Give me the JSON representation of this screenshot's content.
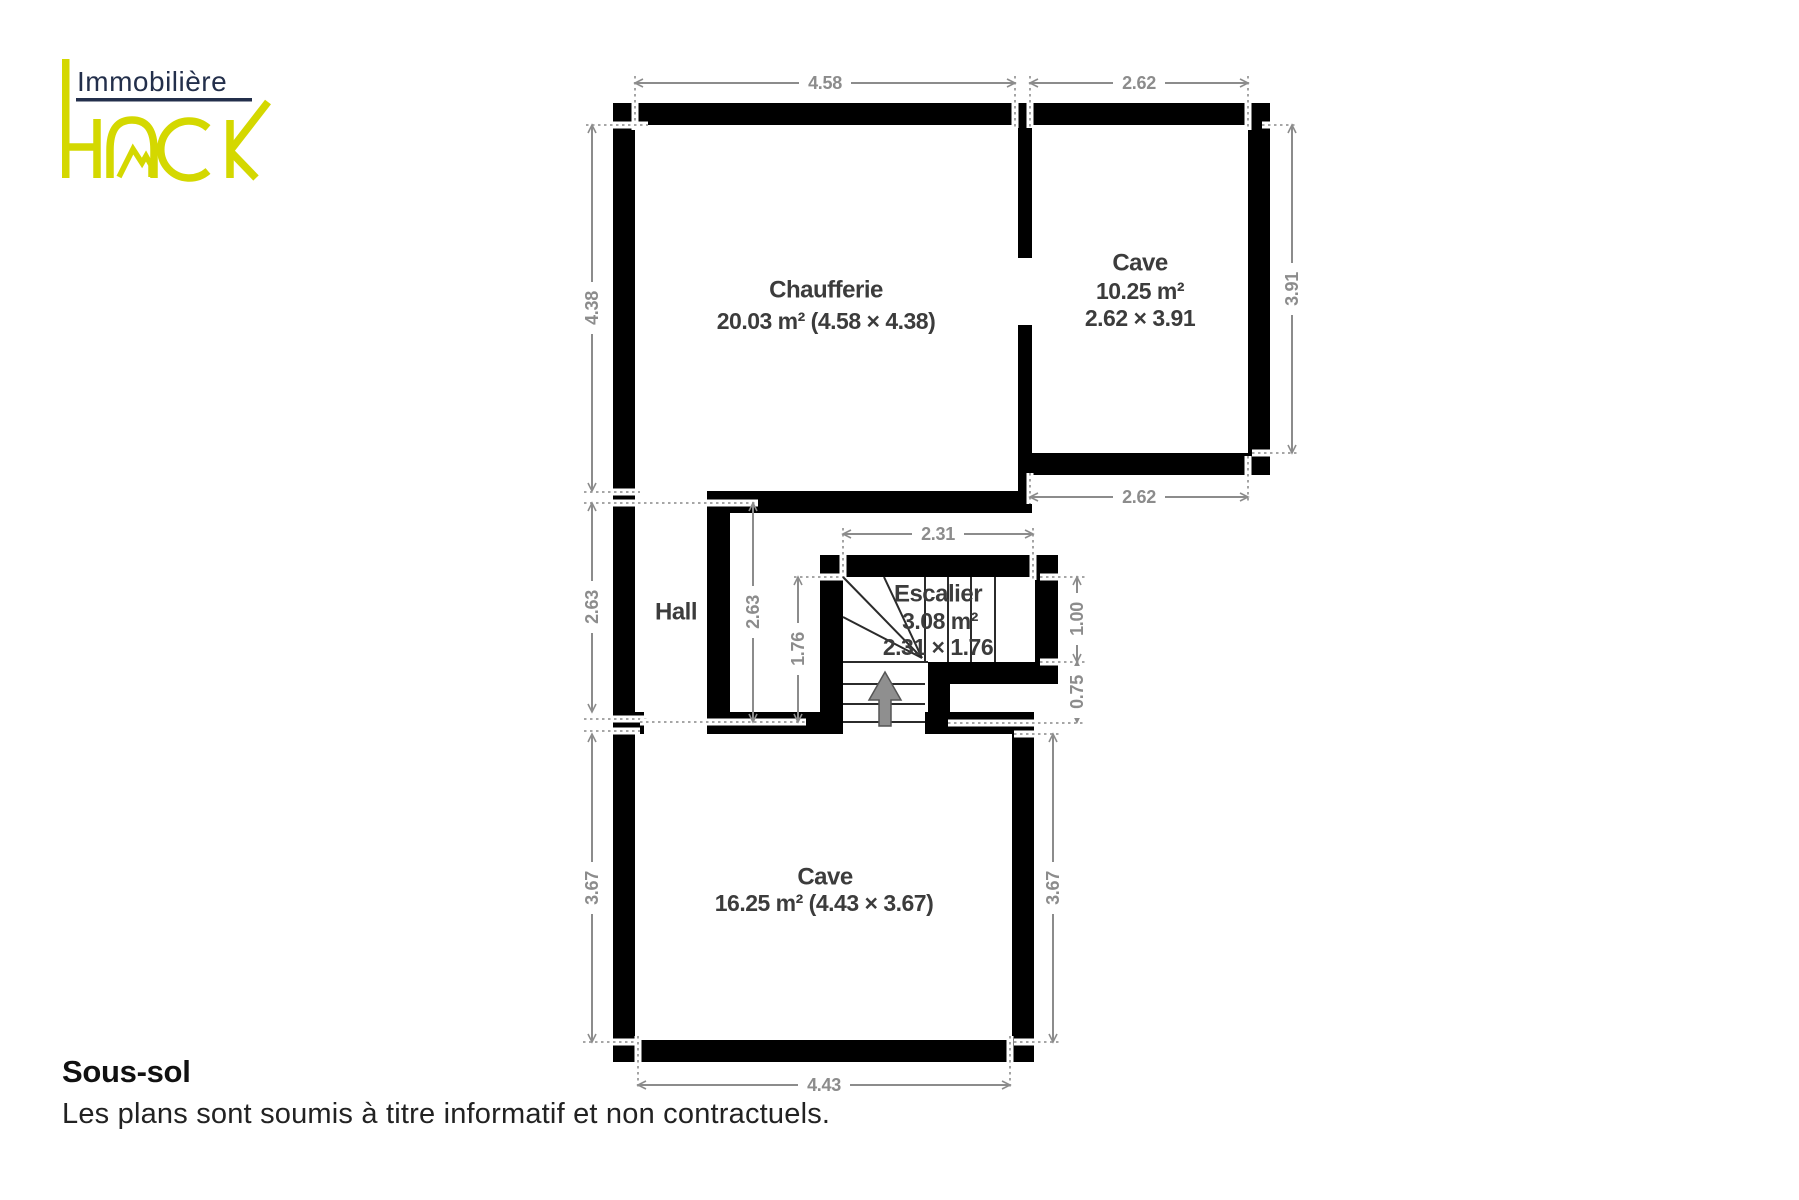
{
  "logo": {
    "company": "Immobilière",
    "brand": "HACK",
    "navy": "#232f4b",
    "yellow": "#d4d800"
  },
  "plan": {
    "rooms": {
      "chaufferie": {
        "name": "Chaufferie",
        "details": "20.03 m² (4.58 × 4.38)"
      },
      "cave_top": {
        "name": "Cave",
        "area": "10.25 m²",
        "size": "2.62 × 3.91"
      },
      "escalier": {
        "name": "Escalier",
        "area": "3.08 m²",
        "size": "2.31 × 1.76"
      },
      "hall": {
        "name": "Hall"
      },
      "cave_bottom": {
        "name": "Cave",
        "details": "16.25 m² (4.43 × 3.67)"
      }
    },
    "dims": {
      "d_458": "4.58",
      "d_262_top": "2.62",
      "d_391": "3.91",
      "d_262_bottom": "2.62",
      "d_438": "4.38",
      "d_263_left": "2.63",
      "d_367_left": "3.67",
      "d_263_inner": "2.63",
      "d_176": "1.76",
      "d_231": "2.31",
      "d_100": "1.00",
      "d_075": "0.75",
      "d_367_right": "3.67",
      "d_443": "4.43"
    },
    "icons": {
      "stairs_direction": "up-arrow"
    },
    "colors": {
      "wall": "#000000",
      "room_label": "#3c3c3c",
      "dimension": "#8c8c8c",
      "stair_arrow": "#8f8f8f",
      "background": "#ffffff"
    }
  },
  "footer": {
    "title": "Sous-sol",
    "disclaimer": "Les plans sont soumis à titre informatif et non contractuels."
  }
}
